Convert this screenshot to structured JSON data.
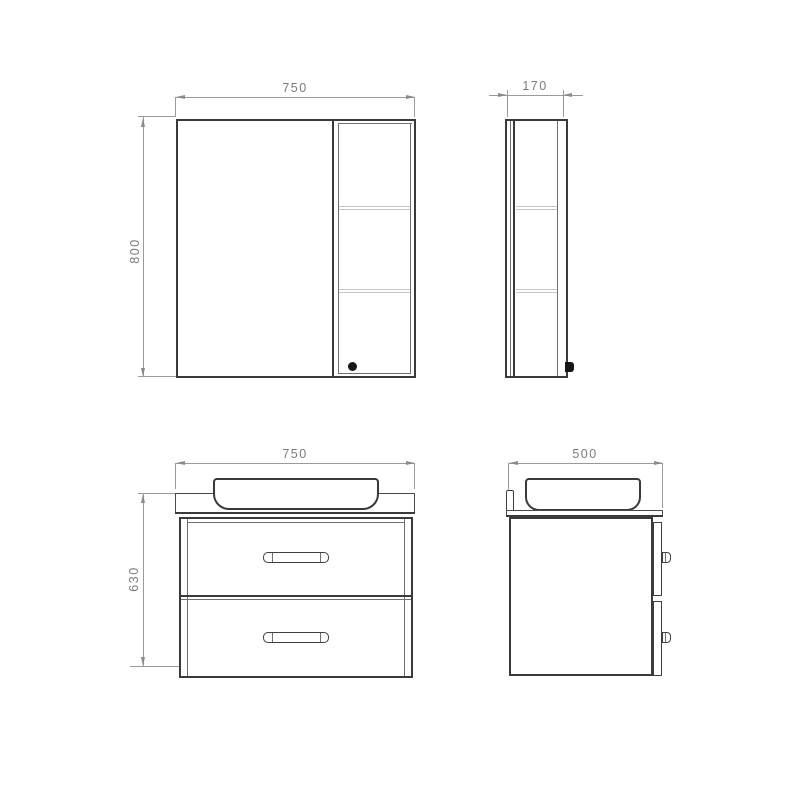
{
  "canvas": {
    "background": "#ffffff"
  },
  "colors": {
    "outline": "#3a3a3a",
    "secondary_line": "#6f6f6f",
    "shelf_line": "#c6c6c6",
    "dimension_line": "#8a8a8a",
    "dimension_text": "#7a7a7a"
  },
  "views": {
    "mirror_cabinet_front": {
      "width_label": "750",
      "height_label": "800"
    },
    "mirror_cabinet_side": {
      "depth_label": "170"
    },
    "vanity_front": {
      "width_label": "750",
      "height_label": "630"
    },
    "vanity_side": {
      "depth_label": "500"
    }
  }
}
